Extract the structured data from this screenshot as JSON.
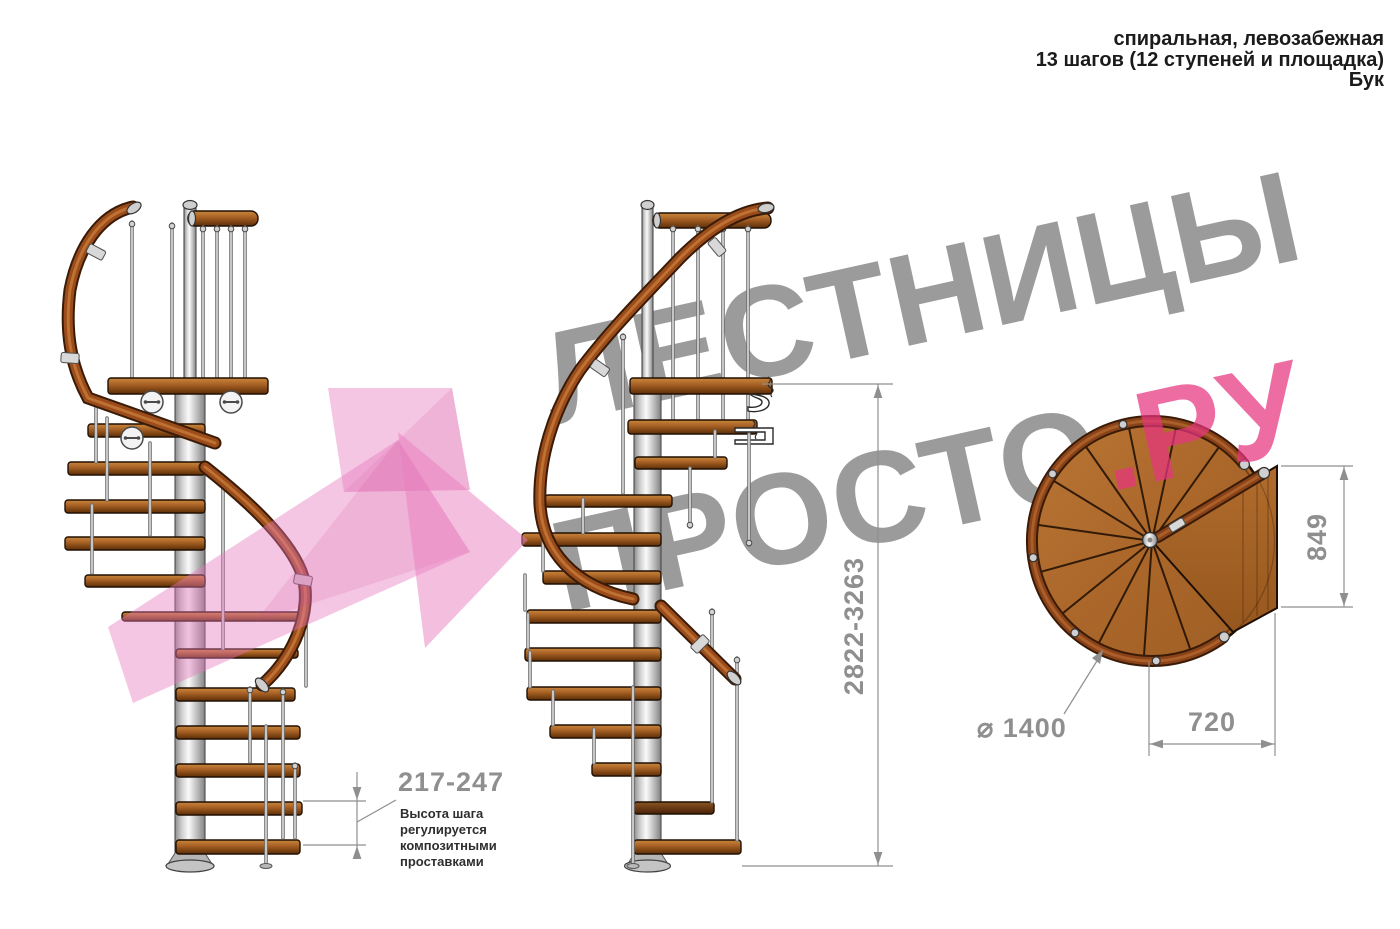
{
  "header": {
    "line1": "спиральная, левозабежная",
    "line2": "13 шагов (12 ступеней и площадка)",
    "line3": "Бук"
  },
  "watermark": {
    "line1": "ЛЕСТНИЦЫ",
    "line2_gray": "ПРОСТО",
    "line2_pink": ".РУ"
  },
  "dimensions": {
    "total_height": "2822-3263",
    "step_height": "217-247",
    "platform_depth": "849",
    "platform_width": "720",
    "diameter": "⌀ 1400"
  },
  "annotation": {
    "line1": "Высота шага",
    "line2": "регулируется",
    "line3": "композитными",
    "line4": "проставками"
  },
  "colors": {
    "wood": "#ad6a2e",
    "handrail": "#8a4617",
    "metal_pole": "#d9d9d9",
    "dimension_gray": "#8f8f8f",
    "watermark_gray": "#9b9b9b",
    "accent_pink": "#e63480",
    "logo_pink": "#f3bddd",
    "text_dark": "#1b1b1b"
  }
}
